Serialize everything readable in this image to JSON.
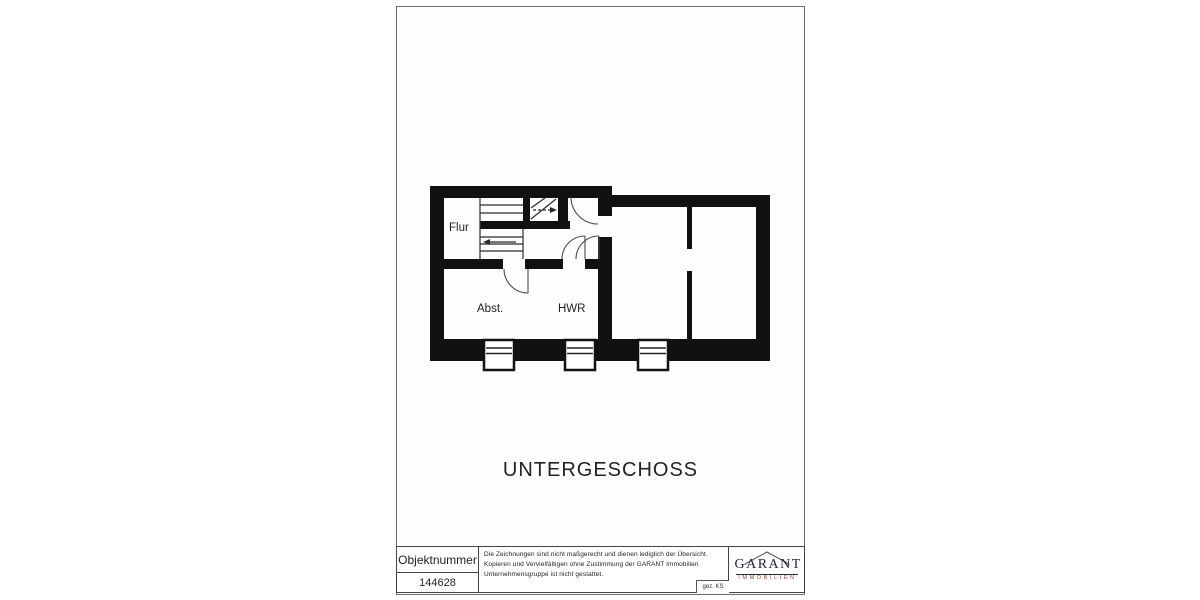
{
  "sheet": {
    "plan": {
      "floor_title": "UNTERGESCHOSS",
      "rooms": [
        {
          "label": "Flur"
        },
        {
          "label": "Abst."
        },
        {
          "label": "HWR"
        }
      ]
    },
    "title_block": {
      "object_number_label": "Objektnummer",
      "object_number": "144628",
      "disclaimer": "Die Zeichnungen sind nicht maßgerecht und dienen lediglich der Übersicht. Kopieren und Vervielfältigen ohne Zustimmung der GARANT Immobilien Unternehmensgruppe ist nicht gestattet.",
      "drawn_by": "gez. KS",
      "logo": {
        "name": "GARANT",
        "subtitle": "IMMOBILIEN"
      }
    },
    "colors": {
      "ink": "#111111",
      "line": "#333333",
      "logo_text": "#23233a",
      "logo_subtitle": "#8b4541"
    }
  }
}
